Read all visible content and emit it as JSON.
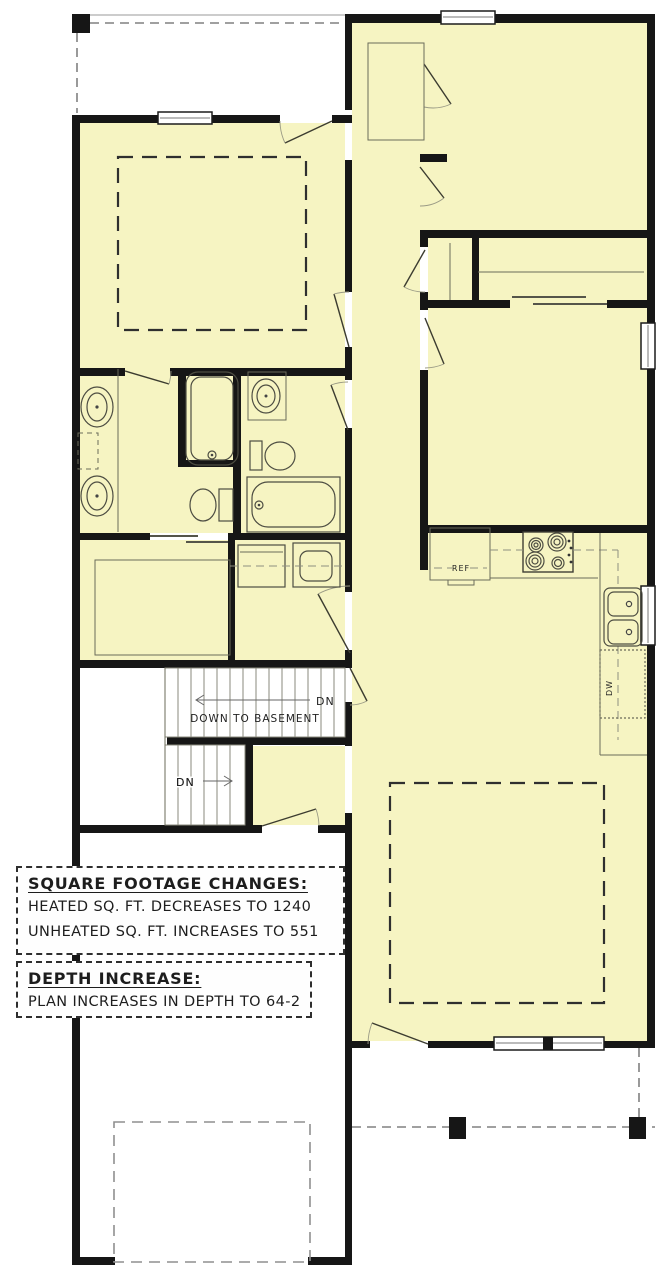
{
  "colors": {
    "wall": "#161616",
    "room": "#f6f4c2",
    "line": "#6b6b5a"
  },
  "notes": {
    "sqft": {
      "title": "SQUARE FOOTAGE CHANGES:",
      "lines": [
        "HEATED SQ. FT. DECREASES TO 1240",
        "UNHEATED SQ. FT. INCREASES TO 551"
      ]
    },
    "depth": {
      "title": "DEPTH INCREASE:",
      "lines": [
        "PLAN INCREASES IN DEPTH TO 64-2"
      ]
    }
  },
  "stairs": {
    "down_to_basement": "DOWN TO BASEMENT",
    "dn_upper": "DN",
    "dn_lower": "DN"
  },
  "kitchen": {
    "ref_label": "REF",
    "dw_label": "DW"
  }
}
